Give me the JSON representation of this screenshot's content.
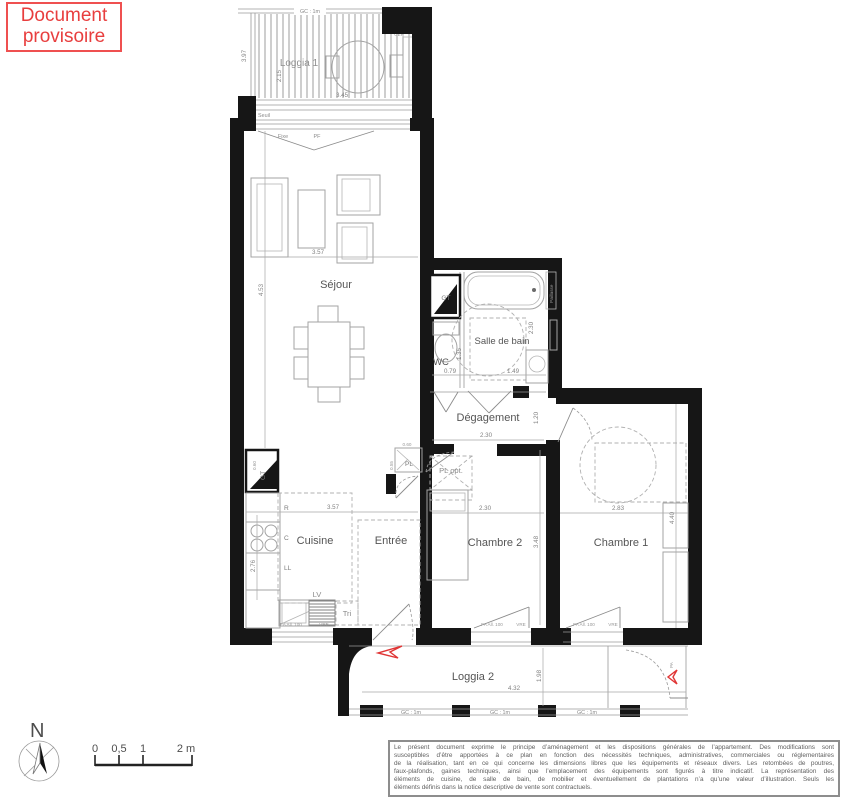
{
  "badge": {
    "text": "Document provisoire"
  },
  "rooms": {
    "loggia1": "Loggia 1",
    "sejour": "Séjour",
    "wc": "WC",
    "salle_de_bain": "Salle de bain",
    "degagement": "Dégagement",
    "pl_opt": "PL opt.",
    "pl": "PL",
    "cuisine": "Cuisine",
    "entree": "Entrée",
    "chambre2": "Chambre 2",
    "chambre1": "Chambre 1",
    "loggia2": "Loggia 2"
  },
  "dimensions": {
    "loggia1_width": "3.45",
    "loggia1_depth": "2.15",
    "loggia1_outer": "3.97",
    "sejour_width": "3.57",
    "sejour_height": "4.53",
    "wc_width": "0.79",
    "wc_depth": "1.35",
    "sdb_width": "1.49",
    "sdb_height": "2.30",
    "degagement_width": "2.30",
    "degagement_depth": "1.20",
    "pl_width": "0.60",
    "pl_depth": "0.55",
    "gt_width": "0.60",
    "cuisine_width": "3.57",
    "cuisine_height": "2.76",
    "chambre2_width": "2.30",
    "chambre2_height": "3.48",
    "chambre1_width": "2.83",
    "chambre1_height": "4.40",
    "loggia2_width": "4.32",
    "loggia2_depth": "1.98"
  },
  "annotations": {
    "gc_rail": "GC : 1m",
    "seuil": "Seuil",
    "fixe": "Fixe",
    "pf": "PF",
    "cep": "CEP",
    "gt": "GT",
    "fridge": "R",
    "hob": "C",
    "washer": "LL",
    "dishwasher": "LV",
    "tri": "Tri",
    "window_type": "FA All. 100",
    "shutter": "VRE",
    "door_pa": "PA",
    "paillasse": "Paillasse"
  },
  "compass": {
    "north": "N"
  },
  "scale_bar": {
    "zero": "0",
    "half": "0,5",
    "one": "1",
    "two": "2 m"
  },
  "disclaimer": {
    "lines": [
      "Le présent document exprime le principe d’aménagement et les dispositions générales de l’appartement. Des modifications sont",
      "susceptibles d’être apportées à ce plan en fonction des nécessités techniques, administratives, commerciales ou réglementaires",
      "de la réalisation, tant en ce qui concerne les dimensions libres que les équipements et réseaux divers. Les retombées de poutres,",
      "faux-plafonds, gaines techniques, ainsi que l’emplacement des équipements sont figurés à titre indicatif. La représentation des",
      "éléments de cuisine, de salle de bain, de mobilier et éventuellement de plantations n’a qu’une valeur d’illustration. Seuls les",
      "éléments définis dans la notice descriptive de vente sont contractuels."
    ]
  }
}
